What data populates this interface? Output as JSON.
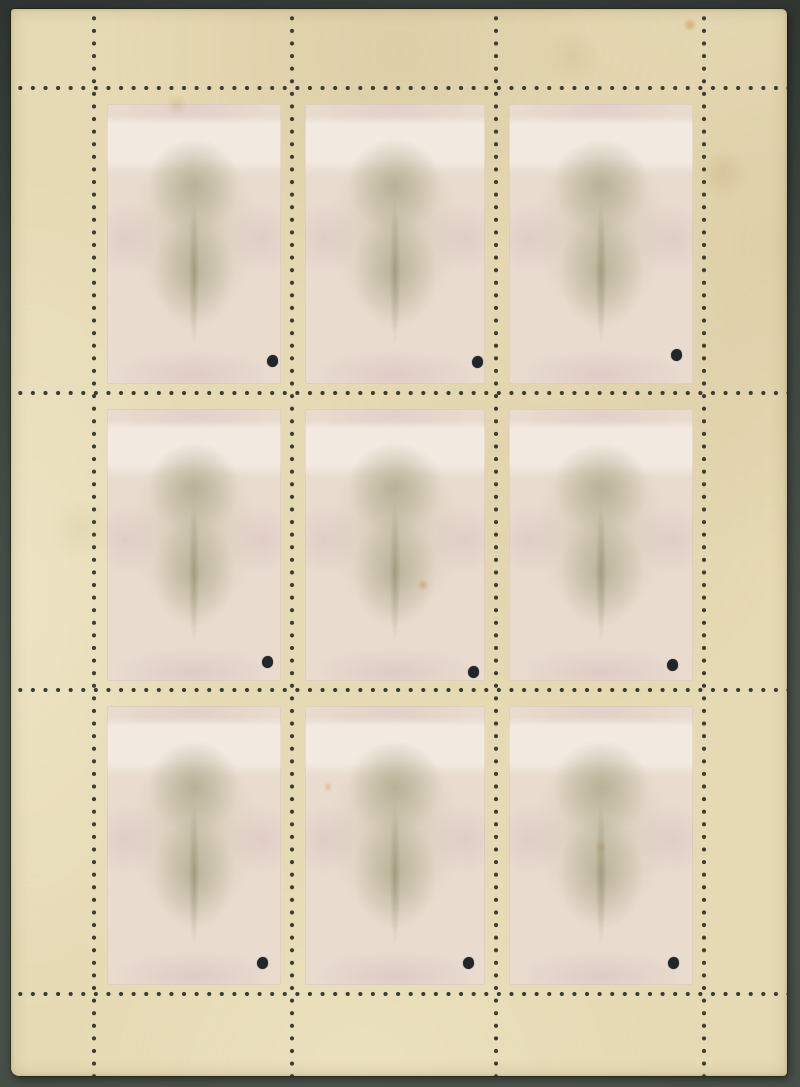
{
  "scene": {
    "subject": "back of a mint stamp sheetlet of nine stamps with perforations and punch holes, photographed on a dark grey backdrop",
    "visible_text": ""
  },
  "image": {
    "width": 800,
    "height": 1087
  },
  "palette": {
    "backdrop": "#3a413b",
    "backdrop_dark": "#2d332e",
    "paper": "#e6dab4",
    "stamp_ghost_base": "#e9dccf",
    "ghost_olive": "#b2ad8e",
    "ghost_olive_soft": "rgba(170,165,134,0.72)",
    "ghost_olive_soft2": "rgba(166,161,130,0.62)",
    "ghost_lilac": "#dcc9cc",
    "perf_hole": "#2f342d",
    "punch": "#20262a"
  },
  "sheet": {
    "left": 11,
    "top": 9,
    "width": 776,
    "height": 1067
  },
  "perforation": {
    "vertical_x": [
      83,
      281,
      485,
      693
    ],
    "horizontal_y": [
      79,
      384,
      681,
      985
    ],
    "dot_pitch": 12.6,
    "dot_diameter": 4.6
  },
  "stamps": {
    "rows": 3,
    "cols": 3,
    "count": 9
  },
  "punch_holes": [
    {
      "x": 261,
      "y": 352
    },
    {
      "x": 466,
      "y": 353
    },
    {
      "x": 665,
      "y": 346
    },
    {
      "x": 256,
      "y": 653
    },
    {
      "x": 462,
      "y": 663
    },
    {
      "x": 661,
      "y": 656
    },
    {
      "x": 251,
      "y": 954
    },
    {
      "x": 457,
      "y": 954
    },
    {
      "x": 662,
      "y": 954
    }
  ],
  "stains": [
    {
      "x": 679,
      "y": 16,
      "r": 7,
      "color": "rgba(196,120,40,0.45)"
    },
    {
      "x": 712,
      "y": 164,
      "r": 26,
      "color": "rgba(170,120,60,0.16)"
    },
    {
      "x": 412,
      "y": 576,
      "r": 6,
      "color": "rgba(200,120,50,0.40)"
    },
    {
      "x": 317,
      "y": 778,
      "r": 5,
      "color": "rgba(200,130,60,0.35)"
    },
    {
      "x": 166,
      "y": 96,
      "r": 11,
      "color": "rgba(180,140,80,0.22)"
    },
    {
      "x": 560,
      "y": 48,
      "r": 30,
      "color": "rgba(160,130,70,0.12)"
    },
    {
      "x": 590,
      "y": 838,
      "r": 6,
      "color": "rgba(190,125,55,0.30)"
    },
    {
      "x": 70,
      "y": 520,
      "r": 34,
      "color": "rgba(150,125,70,0.08)"
    }
  ]
}
